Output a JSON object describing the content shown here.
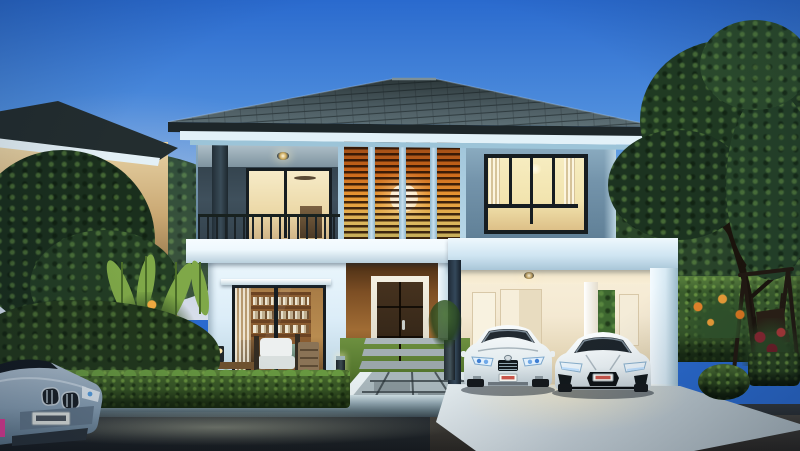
{
  "image_type": "photorealistic architectural rendering (no on-screen text)",
  "title": "Modern two-storey house exterior at dusk",
  "scene": {
    "time_of_day": "dusk, clear gradient sky, interior lights on",
    "main_house": {
      "roof": "dark slate hip roof with white soffit band",
      "upper_floor": {
        "wall": "blue-grey render",
        "balcony": "recessed balcony with black metal railing and warm-lit sliding glass door",
        "feature_screen": "four vertical timber-louvre panels glowing amber with round white pendant lamp",
        "right_window": "black-framed window, warm interior light, sheer curtains"
      },
      "ground_floor": {
        "wall": "white render",
        "study_window": "black-framed sliding glass wall showing timber bookshelf full of books",
        "entrance": "timber-clad wall with white-framed dark wooden double door",
        "carport": "white portal-frame double carport, cream lit interior, vertical-garden panel"
      }
    },
    "vehicles": {
      "sedan": "white luxury sedan parked in carport, blue-tinted headlights, red-on-white plate",
      "sports_car": "white mid-engine coupe parked in carport, red-on-white plate",
      "street_car": "silver-blue car front, parked on road at lower left"
    },
    "landscape": {
      "front": "low trimmed box hedge, lawn, paver walkway and outdoor timber lounge set with white cushions, bollard lights",
      "left": "neighbouring cream house with lit windows behind tropical planting and banana leaves, orange flowers",
      "right": "tall clipped hedge wall, large tree, timber A-frame swing, orange and red flowering border, round shrub",
      "hard": "grey paver driveway, concrete kerb, dark asphalt road with light streak"
    }
  },
  "palette": {
    "sky_top": "#2a6ace",
    "sky_mid": "#74aee6",
    "sky_horizon": "#cfe9f6",
    "roof": "#46565c",
    "roof_dark": "#2a3336",
    "fascia": "#1d2629",
    "soffit": "#e2f1f8",
    "wall_upper": "#7494ab",
    "balcony_wall": "#3f505c",
    "slab": "#eef8fd",
    "wall_lower": "#dcedf8",
    "glow_amber": "#e89a35",
    "glow_deep": "#8a3c10",
    "frame_dark": "#161d21",
    "interior_warm": "#f2e4ae",
    "wood_wall": "#7c4e24",
    "door_wood": "#38291a",
    "carport_face": "#cfe5f2",
    "carport_inner": "#f4e9d2",
    "hedge": "#3c5c28",
    "hedge_light": "#679840",
    "grass": "#55772e",
    "tree_dark": "#17291b",
    "tree_mid": "#2a452a",
    "road": "#24292d",
    "curb": "#8ea3ad",
    "driveway": "#c7d2d8",
    "car_white": "#eef3f6",
    "plate_red": "#c23a2e",
    "bmw_silver": "#9fb6c8"
  }
}
